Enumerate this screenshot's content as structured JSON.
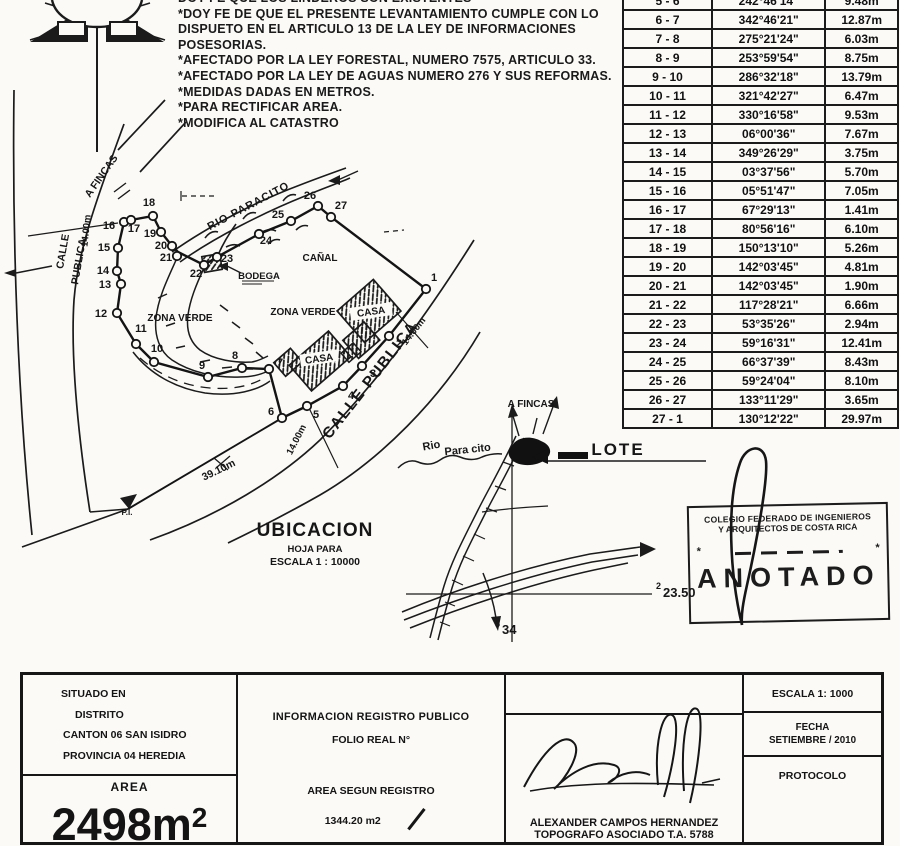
{
  "notes": {
    "lines": [
      "DOY FE QUE LOS LINDEROS SON EXISTENTES",
      "*DOY FE DE QUE EL PRESENTE LEVANTAMIENTO CUMPLE CON LO",
      "DISPUETO EN EL ARTICULO 13 DE LA LEY DE INFORMACIONES",
      "POSESORIAS.",
      "*AFECTADO POR LA LEY FORESTAL, NUMERO 7575, ARTICULO 33.",
      "*AFECTADO POR LA LEY DE AGUAS NUMERO 276 Y SUS REFORMAS.",
      "*MEDIDAS DADAS EN METROS.",
      "*PARA RECTIFICAR AREA.",
      "*MODIFICA AL  CATASTRO"
    ]
  },
  "bearing_table": {
    "rows": [
      [
        "5 - 6",
        "242°46'14\"",
        "9.48m"
      ],
      [
        "6 - 7",
        "342°46'21\"",
        "12.87m"
      ],
      [
        "7 - 8",
        "275°21'24\"",
        "6.03m"
      ],
      [
        "8 - 9",
        "253°59'54\"",
        "8.75m"
      ],
      [
        "9 - 10",
        "286°32'18\"",
        "13.79m"
      ],
      [
        "10 - 11",
        "321°42'27\"",
        "6.47m"
      ],
      [
        "11 - 12",
        "330°16'58\"",
        "9.53m"
      ],
      [
        "12 - 13",
        "06°00'36\"",
        "7.67m"
      ],
      [
        "13 - 14",
        "349°26'29\"",
        "3.75m"
      ],
      [
        "14 - 15",
        "03°37'56\"",
        "5.70m"
      ],
      [
        "15 - 16",
        "05°51'47\"",
        "7.05m"
      ],
      [
        "16 - 17",
        "67°29'13\"",
        "1.41m"
      ],
      [
        "17 - 18",
        "80°56'16\"",
        "6.10m"
      ],
      [
        "18 - 19",
        "150°13'10\"",
        "5.26m"
      ],
      [
        "19 - 20",
        "142°03'45\"",
        "4.81m"
      ],
      [
        "20 - 21",
        "142°03'45\"",
        "1.90m"
      ],
      [
        "21 - 22",
        "117°28'21\"",
        "6.66m"
      ],
      [
        "22 - 23",
        "53°35'26\"",
        "2.94m"
      ],
      [
        "23 - 24",
        "59°16'31\"",
        "12.41m"
      ],
      [
        "24 - 25",
        "66°37'39\"",
        "8.43m"
      ],
      [
        "25 - 26",
        "59°24'04\"",
        "8.10m"
      ],
      [
        "26 - 27",
        "133°11'29\"",
        "3.65m"
      ],
      [
        "27 - 1",
        "130°12'22\"",
        "29.97m"
      ]
    ]
  },
  "survey_map": {
    "labels": {
      "a_fincas": "A FINCAS",
      "calle1": "CALLE",
      "calle2": "PUBLICA",
      "dim_left": "14.00m",
      "rio": "RIO PARACITO",
      "canal": "CAÑAL",
      "bodega": "BODEGA",
      "zona_verde": "ZONA VERDE",
      "zona_verde2": "ZONA VERDE",
      "casa": "CASA",
      "casa2": "CASA",
      "calle_right": "CALLE PUBLICA",
      "dim_right": "14.00m",
      "dim_bottom": "14.00m",
      "dim_sw": "39.10m",
      "pi": "P.I."
    },
    "vertices": [
      {
        "n": "1",
        "x": 426,
        "y": 289,
        "lx": 434,
        "ly": 281
      },
      {
        "n": "2",
        "x": 389,
        "y": 336,
        "lx": 399,
        "ly": 347
      },
      {
        "n": "3",
        "x": 362,
        "y": 366,
        "lx": 373,
        "ly": 377
      },
      {
        "n": "4",
        "x": 343,
        "y": 386,
        "lx": 351,
        "ly": 399
      },
      {
        "n": "5",
        "x": 307,
        "y": 406,
        "lx": 316,
        "ly": 418
      },
      {
        "n": "6",
        "x": 282,
        "y": 418,
        "lx": 271,
        "ly": 415
      },
      {
        "n": "7",
        "x": 269,
        "y": 369,
        "lx": 280,
        "ly": 366
      },
      {
        "n": "8",
        "x": 242,
        "y": 368,
        "lx": 235,
        "ly": 359
      },
      {
        "n": "9",
        "x": 208,
        "y": 377,
        "lx": 202,
        "ly": 369
      },
      {
        "n": "10",
        "x": 154,
        "y": 362,
        "lx": 157,
        "ly": 352
      },
      {
        "n": "11",
        "x": 136,
        "y": 344,
        "lx": 141,
        "ly": 332
      },
      {
        "n": "12",
        "x": 117,
        "y": 313,
        "lx": 101,
        "ly": 317
      },
      {
        "n": "13",
        "x": 121,
        "y": 284,
        "lx": 105,
        "ly": 288
      },
      {
        "n": "14",
        "x": 117,
        "y": 271,
        "lx": 103,
        "ly": 274
      },
      {
        "n": "15",
        "x": 118,
        "y": 248,
        "lx": 104,
        "ly": 251
      },
      {
        "n": "16",
        "x": 124,
        "y": 222,
        "lx": 109,
        "ly": 229
      },
      {
        "n": "17",
        "x": 131,
        "y": 220,
        "lx": 134,
        "ly": 232
      },
      {
        "n": "18",
        "x": 153,
        "y": 216,
        "lx": 149,
        "ly": 206
      },
      {
        "n": "19",
        "x": 161,
        "y": 232,
        "lx": 150,
        "ly": 237
      },
      {
        "n": "20",
        "x": 172,
        "y": 246,
        "lx": 161,
        "ly": 249
      },
      {
        "n": "21",
        "x": 177,
        "y": 256,
        "lx": 166,
        "ly": 261
      },
      {
        "n": "22",
        "x": 204,
        "y": 265,
        "lx": 196,
        "ly": 277
      },
      {
        "n": "23",
        "x": 217,
        "y": 257,
        "lx": 227,
        "ly": 262
      },
      {
        "n": "24",
        "x": 259,
        "y": 234,
        "lx": 266,
        "ly": 244
      },
      {
        "n": "25",
        "x": 291,
        "y": 221,
        "lx": 278,
        "ly": 218
      },
      {
        "n": "26",
        "x": 318,
        "y": 206,
        "lx": 310,
        "ly": 199
      },
      {
        "n": "27",
        "x": 331,
        "y": 217,
        "lx": 341,
        "ly": 209
      }
    ]
  },
  "ubicacion": {
    "title": "UBICACION",
    "line2": "HOJA PARA",
    "line3": "ESCALA 1 : 10000"
  },
  "location_sketch": {
    "a_fincas": "A FINCAS",
    "rio": "Rio",
    "rio2": "Para cito",
    "lote": "LOTE",
    "coord_e_sup": "2",
    "coord_e": "23.50",
    "coord_n_sup": "5",
    "coord_n": "34"
  },
  "stamp": {
    "line1": "COLEGIO FEDERADO DE INGENIEROS",
    "line2": "Y ARQUITECTOS DE COSTA RICA",
    "star": "*",
    "word": "ANOTADO"
  },
  "footer": {
    "situado": "SITUADO EN",
    "distrito": "DISTRITO",
    "canton": "CANTON 06 SAN ISIDRO",
    "provincia": "PROVINCIA 04 HEREDIA",
    "area_label": "AREA",
    "area_value": "2498m",
    "area_sup": "2",
    "info_registro": "INFORMACION REGISTRO PUBLICO",
    "folio": "FOLIO REAL N°",
    "area_registro_label": "AREA SEGUN REGISTRO",
    "area_registro_value": "1344.20 m2",
    "surveyor_name": "ALEXANDER CAMPOS HERNANDEZ",
    "surveyor_title": "TOPOGRAFO ASOCIADO T.A. 5788",
    "escala": "ESCALA 1: 1000",
    "fecha_label": "FECHA",
    "fecha_value": "SETIEMBRE / 2010",
    "protocolo": "PROTOCOLO"
  }
}
